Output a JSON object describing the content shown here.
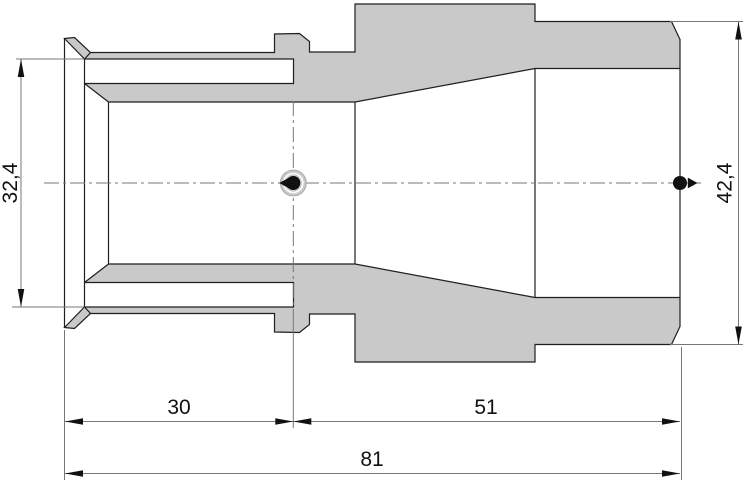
{
  "drawing": {
    "title": "reducing-adapter-cross-section",
    "dimensions": {
      "length_left": "30",
      "length_right": "51",
      "length_total": "81",
      "diameter_left": "32,4",
      "diameter_right": "42,4"
    },
    "colors": {
      "part_fill": "#c9c9c9",
      "outline": "#1f1f1f",
      "dimension_lines": "#777777",
      "text": "#111111",
      "background": "#ffffff"
    },
    "icons": {
      "connection_point_left": "black dot with left arrow on centerline",
      "connection_point_right": "black dot with right arrow on centerline"
    }
  }
}
